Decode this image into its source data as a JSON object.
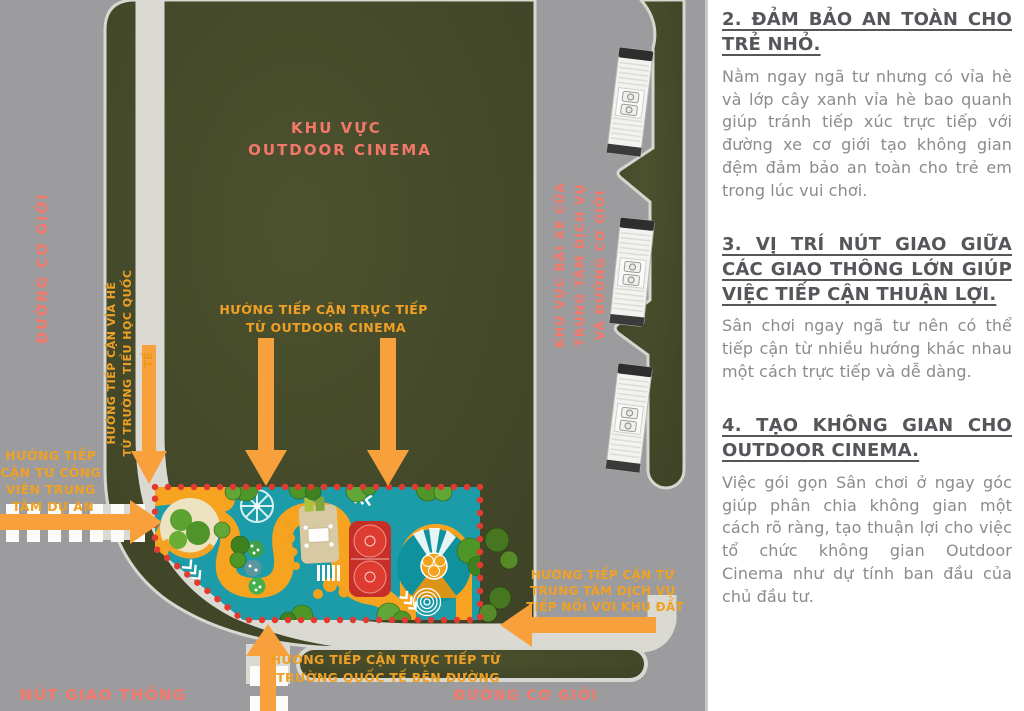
{
  "colors": {
    "road_gray": "#9c9b9e",
    "site_green": "#454a2b",
    "path_light": "#dadad3",
    "arrow_orange": "#f8a13c",
    "label_orange": "#f0a125",
    "label_salmon": "#f4786a",
    "playground_teal": "#1b9ca8",
    "playground_orange": "#f6a41f",
    "court_red": "#c62f28",
    "dotted_border_red": "#e23a30",
    "heading_gray": "#55565a",
    "body_gray": "#8a8b8e"
  },
  "map": {
    "area": {
      "lines": [
        "KHU VỰC",
        "OUTDOOR CINEMA"
      ]
    },
    "road_left": "ĐƯỜNG CƠ GIỚI",
    "road_bottom": "ĐƯỜNG CƠ GIỚI",
    "intersection": "NÚT GIAO THÔNG",
    "parking": {
      "lines": [
        "KHU VỰC BÃI XE CỦA",
        "TRUNG TÂM DỊCH VỤ",
        "VÀ ĐƯỜNG CƠ GIỚI"
      ]
    },
    "access_sidewalk": {
      "lines": [
        "HƯỚNG TIẾP CẬN VỈA HÈ",
        "TỪ TRƯỜNG TIỂU HỌC QUỐC",
        "TẾ"
      ]
    },
    "access_cinema": {
      "lines": [
        "HƯỚNG TIẾP CẬN TRỰC TIẾP",
        "TỪ OUTDOOR CINEMA"
      ]
    },
    "access_park": {
      "lines": [
        "HƯỚNG TIẾP",
        "CẬN TỪ CÔNG",
        "VIÊN TRUNG",
        "TÂM DỰ ÁN"
      ]
    },
    "access_service": {
      "lines": [
        "HƯỚNG TIẾP CẬN TỪ",
        "TRUNG TÂM DỊCH VỤ",
        "TIẾP NỐI VỚI KHU ĐẤT"
      ]
    },
    "access_school": {
      "lines": [
        "HƯỚNG TIẾP CẬN TRỰC TIẾP TỪ",
        "TRƯỜNG QUỐC TẾ BÊN ĐƯỜNG"
      ]
    }
  },
  "panel": {
    "sections": [
      {
        "heading": "2. ĐẢM BẢO AN TOÀN CHO TRẺ NHỎ.",
        "body": "Nằm ngay ngã tư nhưng có vỉa hè và lớp cây xanh vỉa hè bao quanh giúp tránh tiếp xúc trực tiếp với đường xe cơ giới tạo không gian đệm đảm bảo an toàn cho trẻ em trong lúc vui chơi."
      },
      {
        "heading": "3. VỊ TRÍ NÚT GIAO GIỮA CÁC GIAO THÔNG LỚN GIÚP VIỆC TIẾP CẬN THUẬN LỢI.",
        "body": "Sân chơi ngay ngã tư nên có thể tiếp cận từ nhiều hướng khác nhau một cách trực tiếp và dễ dàng."
      },
      {
        "heading": "4. TẠO KHÔNG GIAN CHO OUTDOOR CINEMA.",
        "body": "Việc gói gọn Sân chơi ở ngay góc giúp phân chia không gian một cách rõ ràng, tạo thuận lợi cho việc tổ chức không gian Outdoor Cinema như dự tính ban đầu của chủ đầu tư."
      }
    ]
  }
}
